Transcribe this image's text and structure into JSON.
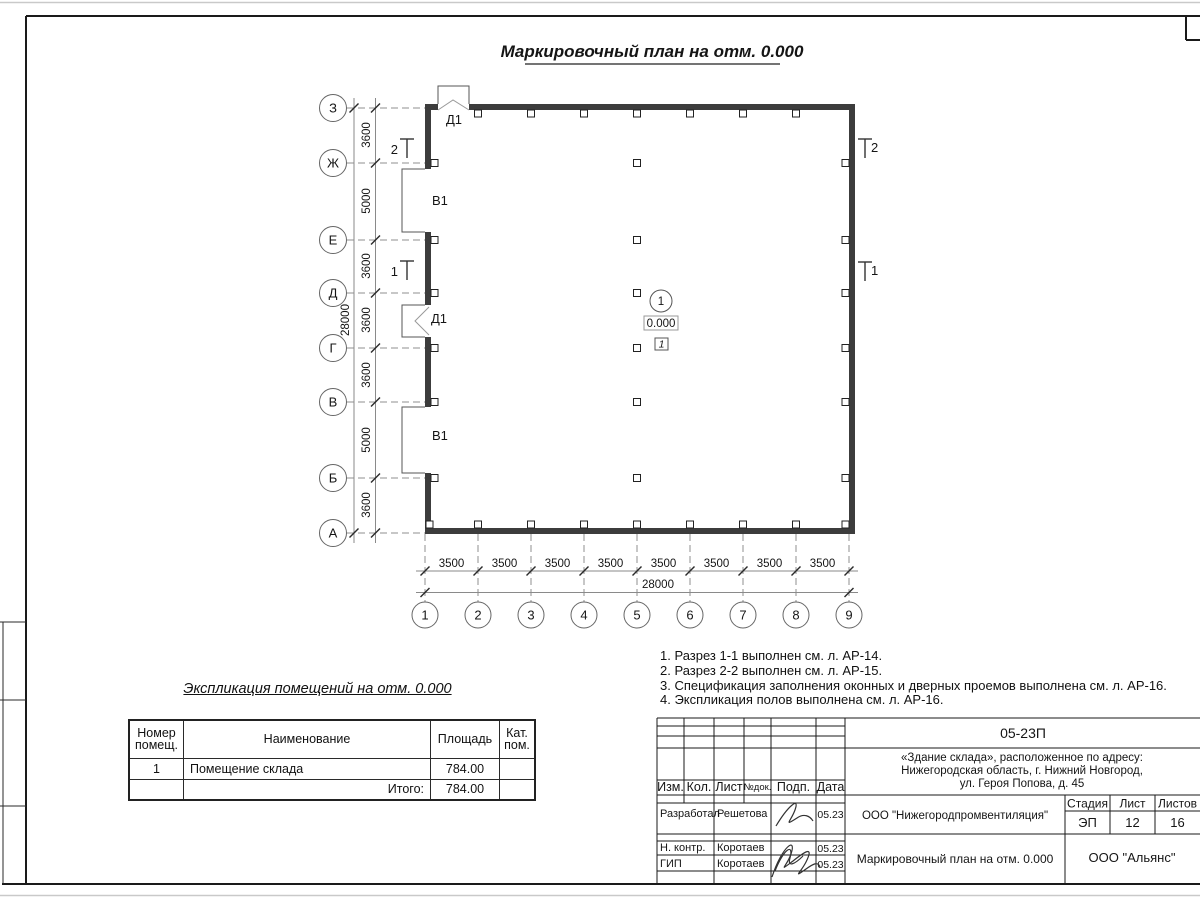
{
  "drawing": {
    "title": "Маркировочный план на отм. 0.000"
  },
  "plan": {
    "axes_left": [
      "З",
      "Ж",
      "Е",
      "Д",
      "Г",
      "В",
      "Б",
      "А"
    ],
    "axes_bottom": [
      "1",
      "2",
      "3",
      "4",
      "5",
      "6",
      "7",
      "8",
      "9"
    ],
    "dims_left": [
      "3600",
      "5000",
      "3600",
      "3600",
      "3600",
      "5000",
      "3600"
    ],
    "dim_left_total": "28000",
    "dims_bottom": [
      "3500",
      "3500",
      "3500",
      "3500",
      "3500",
      "3500",
      "3500",
      "3500"
    ],
    "dim_bottom_total": "28000",
    "door_label": "Д1",
    "window_label": "В1",
    "section_mark_1": "1",
    "section_mark_2": "2",
    "room": {
      "number": "1",
      "elevation": "0.000",
      "floor_type": "1"
    }
  },
  "notes": {
    "lines": [
      "1. Разрез 1-1 выполнен см. л. АР-14.",
      "2. Разрез 2-2 выполнен см. л. АР-15.",
      "3. Спецификация заполнения оконных и дверных проемов выполнена см. л. АР-16.",
      "4. Экспликация полов выполнена см. л. АР-16."
    ]
  },
  "explication": {
    "title": "Экспликация помещений на отм. 0.000",
    "headers": [
      "Номер помещ.",
      "Наименование",
      "Площадь",
      "Кат. пом."
    ],
    "rows": [
      {
        "number": "1",
        "name": "Помещение склада",
        "area": "784.00",
        "cat": ""
      }
    ],
    "total_label": "Итого:",
    "total_value": "784.00"
  },
  "title_block": {
    "code": "05-23П",
    "address_lines": [
      "«Здание склада», расположенное по адресу:",
      "Нижегородская область, г. Нижний Новгород,",
      "ул. Героя Попова, д. 45"
    ],
    "columns": [
      "Изм.",
      "Кол.",
      "Лист",
      "№док.",
      "Подп.",
      "Дата"
    ],
    "rows": [
      {
        "role": "Разработал",
        "name": "Решетова",
        "date": "05.23"
      },
      {
        "role": "Н. контр.",
        "name": "Коротаев",
        "date": "05.23"
      },
      {
        "role": "ГИП",
        "name": "Коротаев",
        "date": "05.23"
      }
    ],
    "org": "ООО \"Нижегородпромвентиляция\"",
    "stage_label": "Стадия",
    "sheet_label": "Лист",
    "sheets_label": "Листов",
    "stage": "ЭП",
    "sheet": "12",
    "sheets": "16",
    "doc_title": "Маркировочный план на отм. 0.000",
    "company": "ООО \"Альянс\""
  }
}
